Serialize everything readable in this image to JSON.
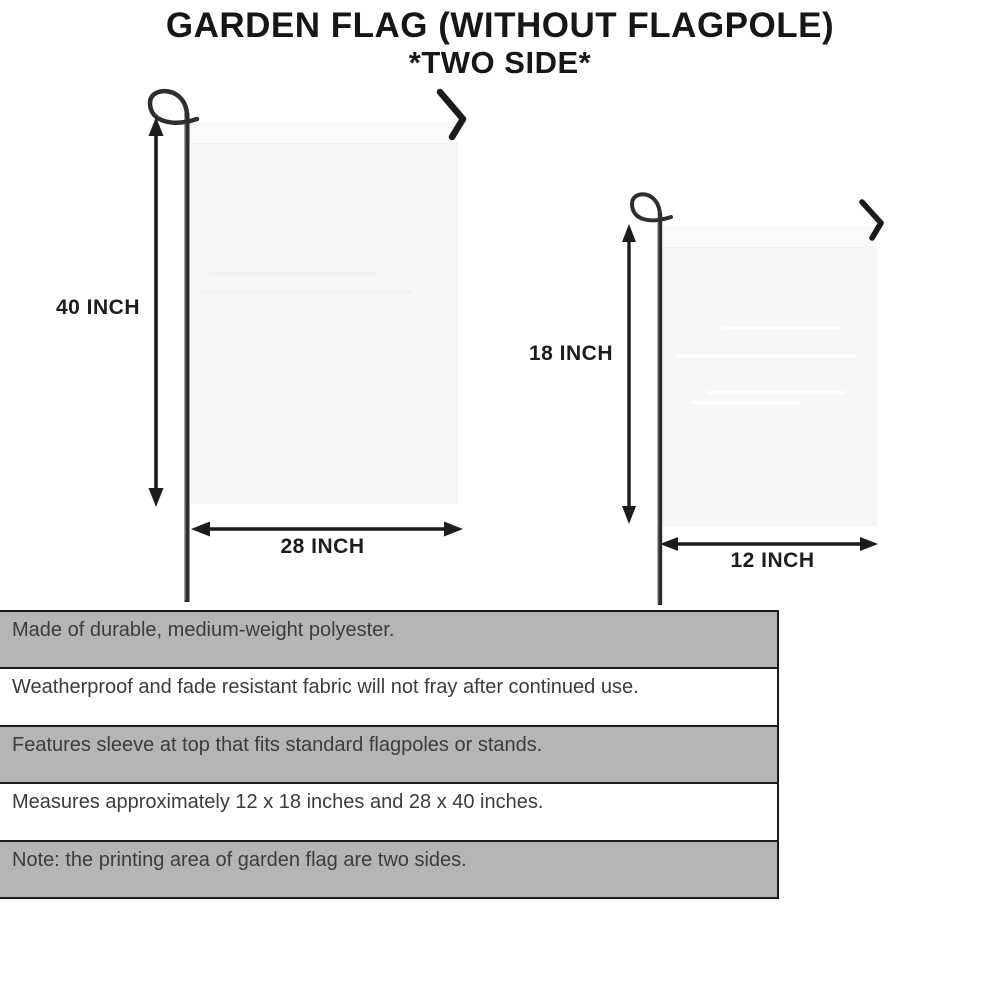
{
  "title": {
    "line1": "GARDEN FLAG (WITHOUT FLAGPOLE)",
    "line2": "*TWO SIDE*"
  },
  "flags": {
    "large": {
      "height_label": "40 INCH",
      "width_label": "28 INCH"
    },
    "small": {
      "height_label": "18 INCH",
      "width_label": "12 INCH"
    }
  },
  "features": [
    {
      "text": "Made of durable, medium-weight polyester.",
      "shaded": true
    },
    {
      "text": "Weatherproof and fade resistant fabric will not fray after continued use.",
      "shaded": false
    },
    {
      "text": "Features sleeve at top that fits standard flagpoles or stands.",
      "shaded": true
    },
    {
      "text": "Measures approximately 12 x 18 inches and 28 x 40 inches.",
      "shaded": false
    },
    {
      "text": "Note: the printing area of garden flag are two sides.",
      "shaded": true
    }
  ],
  "colors": {
    "ink": "#161616",
    "pole": "#3a3a3a",
    "flag": "#f6f6f6",
    "bar-gray": "#b5b5b5",
    "bar-white": "#ffffff",
    "bar-border": "#1a1a1a",
    "feature-text": "#3c3c3c"
  }
}
